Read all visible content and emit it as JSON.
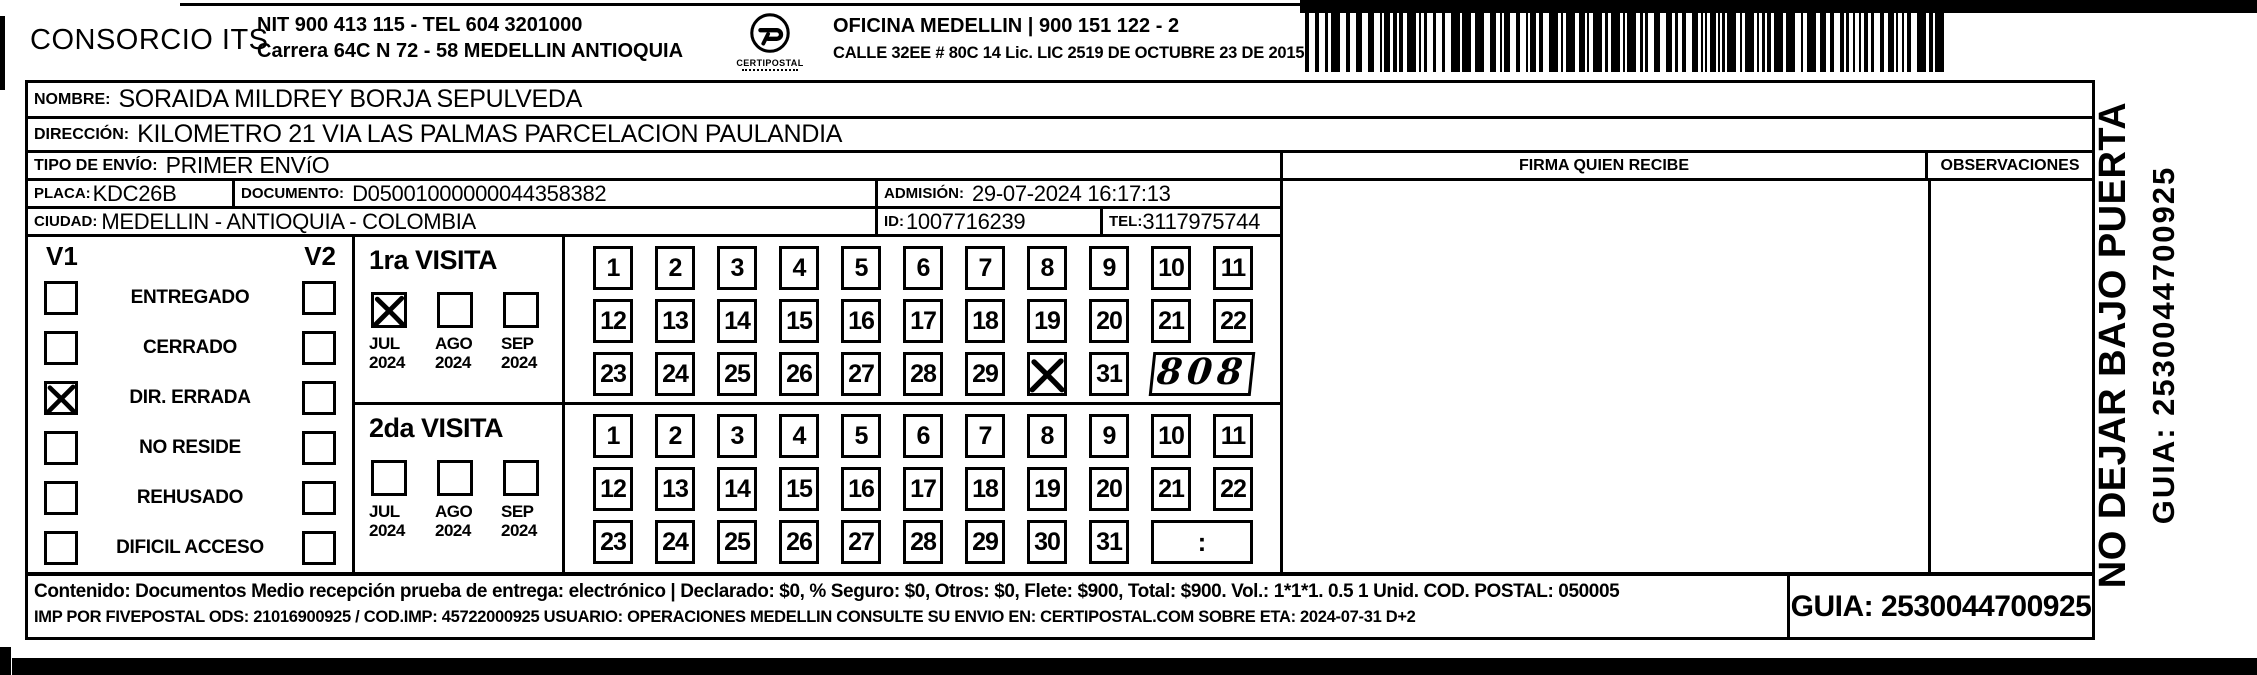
{
  "header": {
    "company": "CONSORCIO ITS",
    "nit_line": "NIT 900 413 115 - TEL 604 3201000",
    "address_line": "Carrera 64C N 72 - 58 MEDELLIN ANTIOQUIA",
    "logo_text": "CERTIPOSTAL",
    "office_line": "OFICINA MEDELLIN | 900 151 122 - 2",
    "license_line": "CALLE 32EE # 80C 14 Lic. LIC 2519 DE OCTUBRE 23 DE 2015"
  },
  "shipment": {
    "nombre_label": "NOMBRE:",
    "nombre": "SORAIDA MILDREY BORJA SEPULVEDA",
    "direccion_label": "DIRECCIÓN:",
    "direccion": "KILOMETRO 21 VIA LAS PALMAS PARCELACION PAULANDIA",
    "tipo_label": "TIPO DE ENVÍO:",
    "tipo": "PRIMER ENVíO",
    "placa_label": "PLACA:",
    "placa": "KDC26B",
    "documento_label": "DOCUMENTO:",
    "documento": "D05001000000044358382",
    "admision_label": "ADMISIÓN:",
    "admision": "29-07-2024 16:17:13",
    "ciudad_label": "CIUDAD:",
    "ciudad": "MEDELLIN - ANTIOQUIA - COLOMBIA",
    "id_label": "ID:",
    "id": "1007716239",
    "tel_label": "TEL:",
    "tel": "3117975744"
  },
  "signature": {
    "firma_header": "FIRMA QUIEN RECIBE",
    "observaciones_header": "OBSERVACIONES"
  },
  "status_panel": {
    "v1_label": "V1",
    "v2_label": "V2",
    "options": [
      {
        "label": "ENTREGADO",
        "v1_checked": false,
        "v2_checked": false
      },
      {
        "label": "CERRADO",
        "v1_checked": false,
        "v2_checked": false
      },
      {
        "label": "DIR. ERRADA",
        "v1_checked": true,
        "v2_checked": false
      },
      {
        "label": "NO RESIDE",
        "v1_checked": false,
        "v2_checked": false
      },
      {
        "label": "REHUSADO",
        "v1_checked": false,
        "v2_checked": false
      },
      {
        "label": "DIFICIL ACCESO",
        "v1_checked": false,
        "v2_checked": false
      }
    ]
  },
  "visits": [
    {
      "title": "1ra VISITA",
      "months": [
        {
          "month": "JUL",
          "year": "2024",
          "checked": true
        },
        {
          "month": "AGO",
          "year": "2024",
          "checked": false
        },
        {
          "month": "SEP",
          "year": "2024",
          "checked": false
        }
      ],
      "days": [
        1,
        2,
        3,
        4,
        5,
        6,
        7,
        8,
        9,
        10,
        11,
        12,
        13,
        14,
        15,
        16,
        17,
        18,
        19,
        20,
        21,
        22,
        23,
        24,
        25,
        26,
        27,
        28,
        29,
        30,
        31
      ],
      "crossed_days": [
        30
      ],
      "note": "808",
      "note_style": "handwritten"
    },
    {
      "title": "2da VISITA",
      "months": [
        {
          "month": "JUL",
          "year": "2024",
          "checked": false
        },
        {
          "month": "AGO",
          "year": "2024",
          "checked": false
        },
        {
          "month": "SEP",
          "year": "2024",
          "checked": false
        }
      ],
      "days": [
        1,
        2,
        3,
        4,
        5,
        6,
        7,
        8,
        9,
        10,
        11,
        12,
        13,
        14,
        15,
        16,
        17,
        18,
        19,
        20,
        21,
        22,
        23,
        24,
        25,
        26,
        27,
        28,
        29,
        30,
        31
      ],
      "crossed_days": [],
      "note": ":",
      "note_style": "printed"
    }
  ],
  "footer": {
    "line1": "Contenido: Documentos Medio recepción prueba de entrega: electrónico | Declarado: $0, % Seguro: $0, Otros: $0, Flete: $900, Total: $900. Vol.: 1*1*1. 0.5 1 Unid. COD. POSTAL: 050005",
    "line2": "IMP POR FIVEPOSTAL ODS: 21016900925 / COD.IMP: 45722000925 USUARIO: OPERACIONES MEDELLIN CONSULTE SU ENVIO EN: CERTIPOSTAL.COM SOBRE ETA: 2024-07-31 D+2",
    "guia_box": "GUIA: 2530044700925"
  },
  "side_note": {
    "line1": "NO DEJAR BAJO PUERTA",
    "line2": "GUIA: 2530044700925"
  }
}
